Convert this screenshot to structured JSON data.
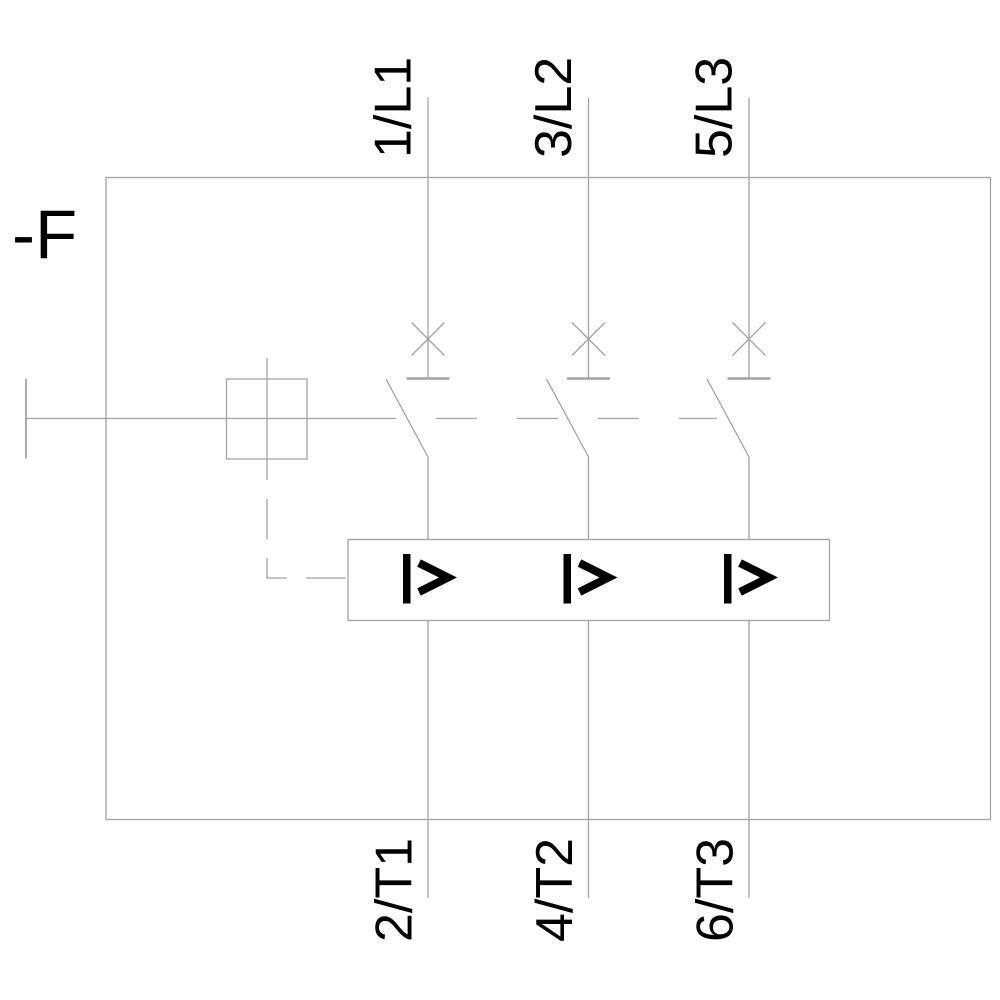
{
  "diagram": {
    "designation_label": "-F",
    "colors": {
      "line": "#a3a3a3",
      "symbol": "#000000",
      "background": "#ffffff"
    },
    "poles": [
      {
        "top_terminal": "1/L1",
        "bottom_terminal": "2/T1"
      },
      {
        "top_terminal": "3/L2",
        "bottom_terminal": "4/T2"
      },
      {
        "top_terminal": "5/L3",
        "bottom_terminal": "6/T3"
      }
    ],
    "icons": {
      "breaker_function": "x-cross-icon",
      "overcurrent_trip": "I>",
      "operator": "square-actuator-icon"
    }
  }
}
